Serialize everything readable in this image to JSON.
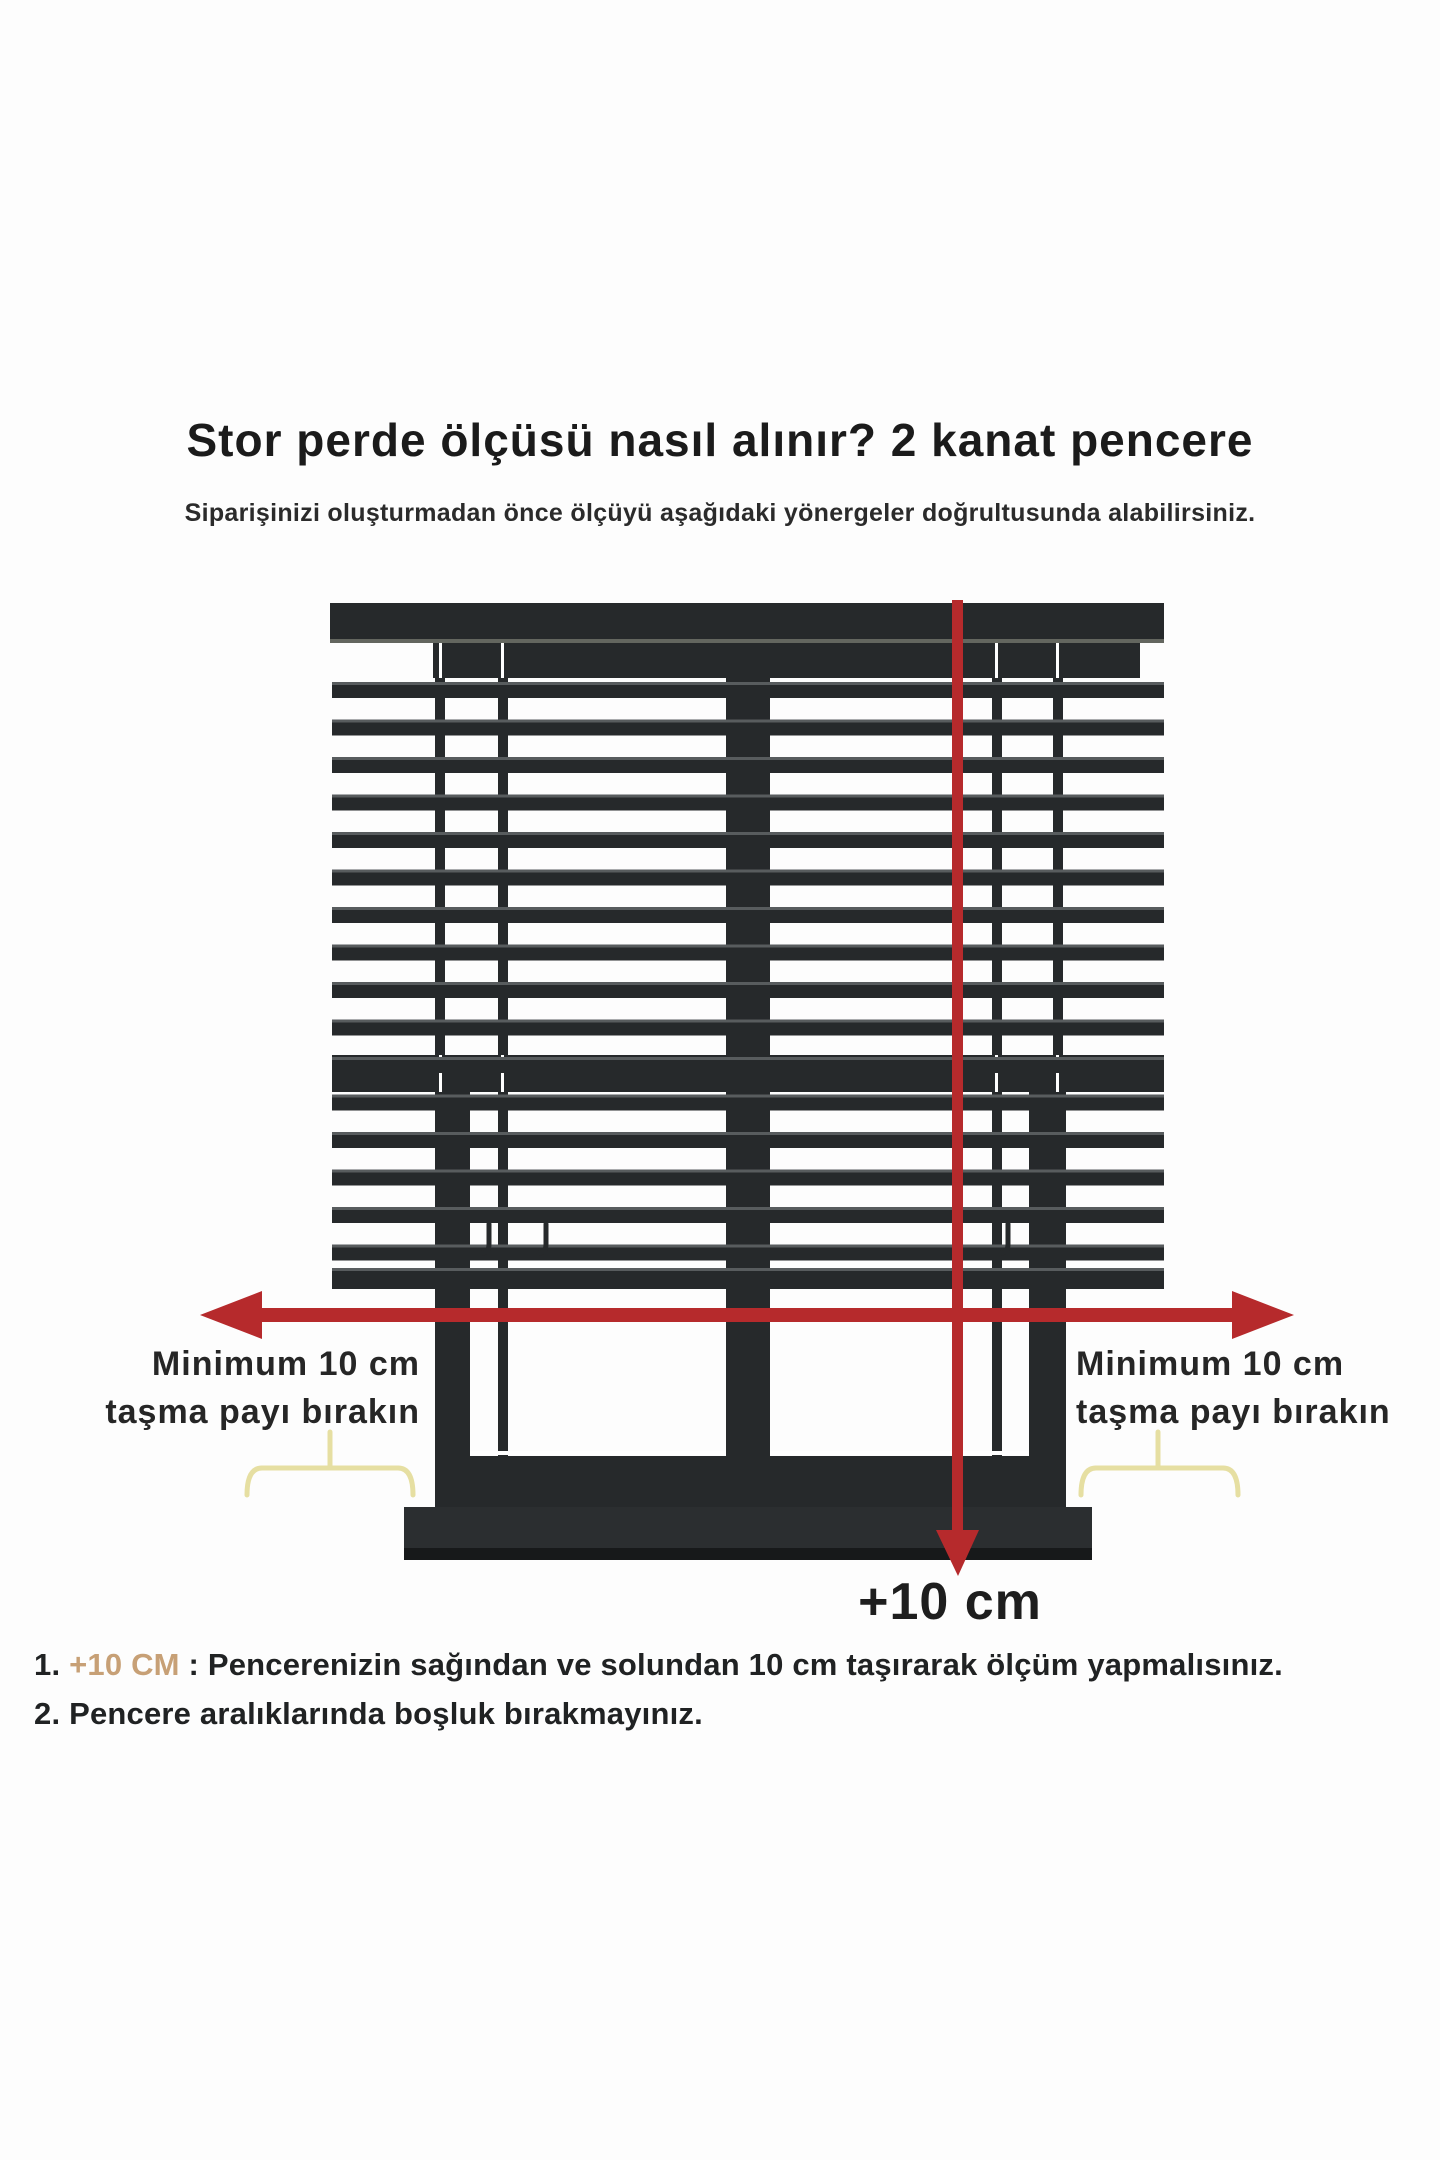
{
  "page": {
    "background": "#fdfdfd"
  },
  "header": {
    "title": "Stor perde ölçüsü nasıl alınır? 2 kanat pencere",
    "subtitle": "Siparişinizi oluşturmadan önce ölçüyü aşağıdaki yönergeler doğrultusunda alabilirsiniz."
  },
  "diagram": {
    "left_margin_label": {
      "line1": "Minimum 10 cm",
      "line2": "taşma payı bırakın"
    },
    "right_margin_label": {
      "line1": "Minimum 10 cm",
      "line2": "taşma payı bırakın"
    },
    "bottom_measure_label": "+10 cm",
    "colors": {
      "frame_dark": "#26292b",
      "slat_hl": "#585c5e",
      "headrail_hl": "#63665f",
      "sill": "#2b2e30",
      "sill_shadow": "#17191a",
      "arrow_red": "#b62a2c",
      "brace_yellow": "#e6dfa2",
      "seam_white": "#ffffff"
    }
  },
  "instructions": {
    "highlight_color": "#c7a076",
    "items": [
      {
        "number": "1. ",
        "highlight": "+10 CM",
        "separator": " : ",
        "text": "Pencerenizin sağından ve solundan 10 cm taşırarak ölçüm yapmalısınız."
      },
      {
        "number": "2. ",
        "highlight": "",
        "separator": "",
        "text": "Pencere aralıklarında boşluk bırakmayınız."
      }
    ]
  }
}
